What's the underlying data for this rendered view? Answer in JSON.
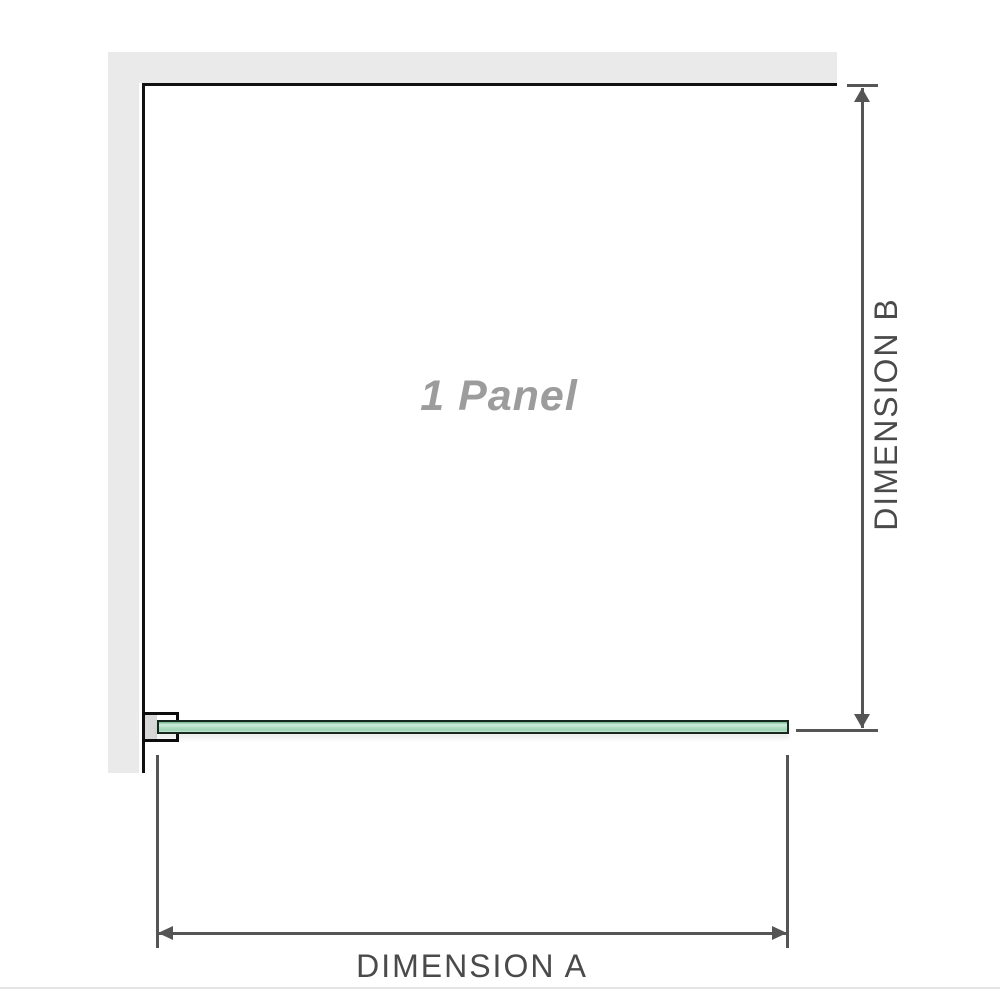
{
  "diagram": {
    "title": "1 Panel",
    "dimensions": {
      "a_label": "DIMENSION A",
      "b_label": "DIMENSION B"
    },
    "colors": {
      "background": "#ffffff",
      "wall_fill": "#eaeaea",
      "wall_edge": "#111111",
      "glass_border": "#16281e",
      "glass_green_dark": "#6fb58d",
      "glass_green_light": "#cfeedd",
      "glass_green_mid": "#abdcc1",
      "bracket_border": "#0d0d0d",
      "bracket_pad": "#d8d8d8",
      "dimension_line": "#555555",
      "dimension_label": "#4a4a4a",
      "panel_label": "#9c9c9c",
      "bottom_rule": "#e4e4e4"
    }
  }
}
